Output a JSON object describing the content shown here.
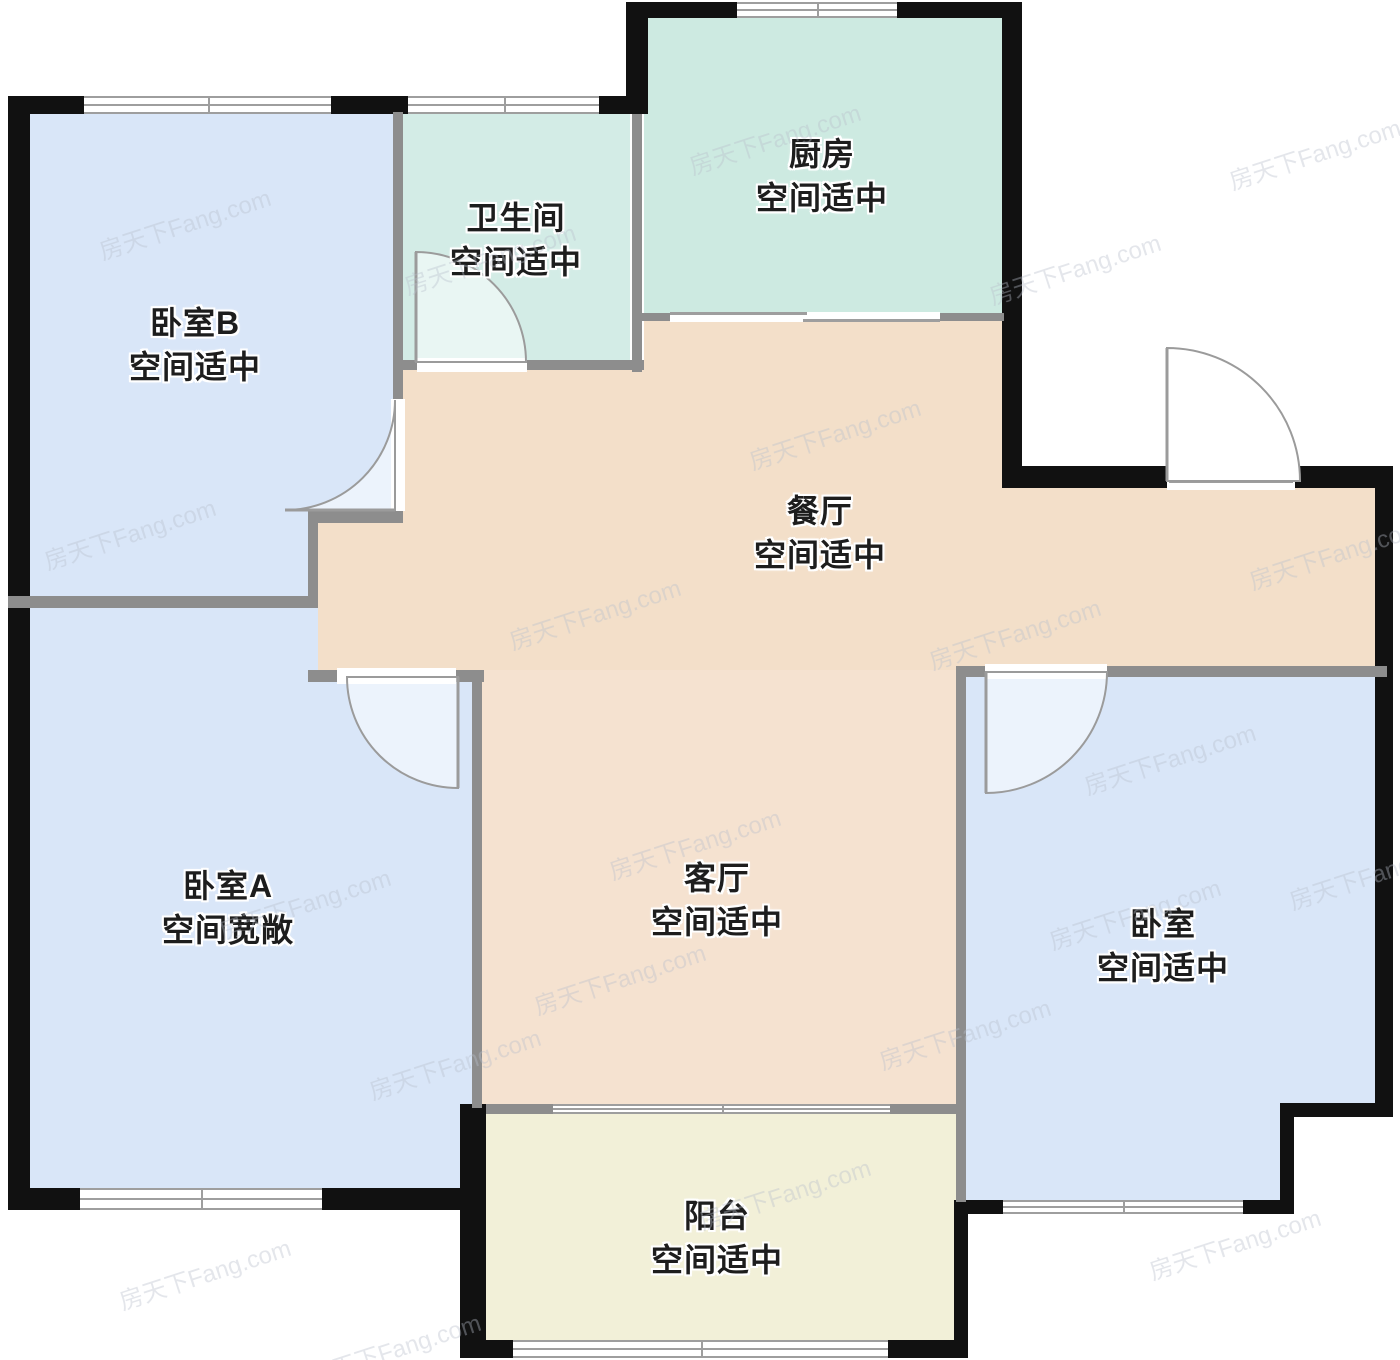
{
  "watermark": "房天下Fang.com",
  "rooms": [
    {
      "id": "bedroom-b",
      "name": "卧室B",
      "status": "空间适中"
    },
    {
      "id": "bathroom",
      "name": "卫生间",
      "status": "空间适中"
    },
    {
      "id": "kitchen",
      "name": "厨房",
      "status": "空间适中"
    },
    {
      "id": "dining",
      "name": "餐厅",
      "status": "空间适中"
    },
    {
      "id": "bedroom-a",
      "name": "卧室A",
      "status": "空间宽敞"
    },
    {
      "id": "living",
      "name": "客厅",
      "status": "空间适中"
    },
    {
      "id": "bedroom",
      "name": "卧室",
      "status": "空间适中"
    },
    {
      "id": "balcony",
      "name": "阳台",
      "status": "空间适中"
    }
  ],
  "colors": {
    "wall": "#111111",
    "inner_wall": "#8d8d8d",
    "window_line": "#9e9e9e",
    "door": "#9b9b9b",
    "floor_bedroom": "#d9e6f8",
    "floor_bath": "#d3ece6",
    "floor_kitchen": "#cdeae1",
    "floor_dining": "#f3dfc9",
    "floor_living": "#f5e2d0",
    "floor_balcony": "#f2f0d8",
    "label": "#1d1d1d",
    "watermark": "#b9c0cc"
  }
}
